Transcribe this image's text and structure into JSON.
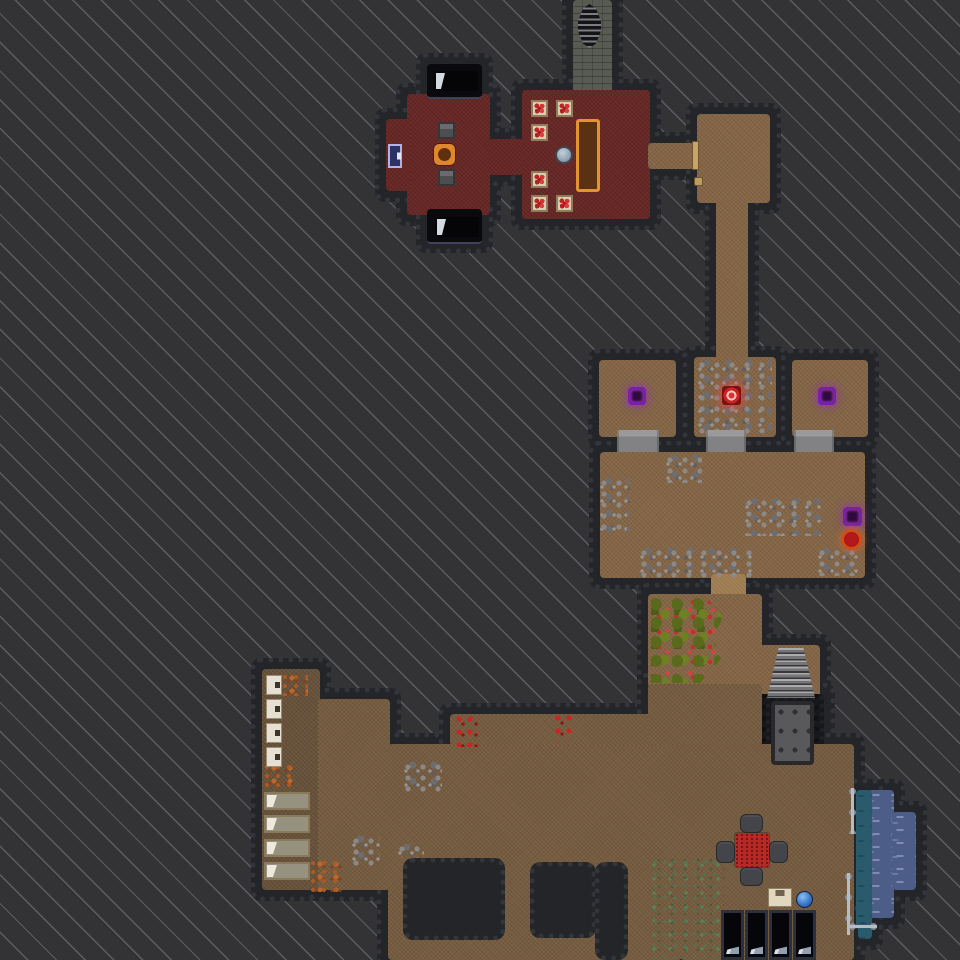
{
  "meta": {
    "width": 960,
    "height": 960,
    "view": "dungeon-overhead-map"
  },
  "palette": {
    "unexplored_bg": "#333336",
    "stripe": "#9ea0a8",
    "wall": "#242529",
    "floor_red": "#6e2c2a",
    "floor_brown": "#8a6b4b",
    "floor_brown_dark": "#6e5840",
    "floor_stone": "#575b51",
    "floor_pit": "#17181b",
    "water": "#4c5d87",
    "shallow_water": "#2a5b6d",
    "rune_purple": "#7b1fa8",
    "rune_red": "#cc2424",
    "table_orange": "#e29433",
    "door_blue": "#2c3166",
    "berry_red": "#c3302a",
    "moss_green": "#4a7a50"
  },
  "map": {
    "rooms": [
      {
        "name": "stone-stair-corridor",
        "kind": "stone",
        "rects": [
          [
            573,
            0,
            39,
            96
          ]
        ]
      },
      {
        "name": "tavern-west-wing",
        "kind": "red",
        "rects": [
          [
            407,
            94,
            83,
            121
          ],
          [
            386,
            119,
            25,
            72
          ]
        ]
      },
      {
        "name": "tavern-connector",
        "kind": "red",
        "rects": [
          [
            488,
            139,
            36,
            36
          ]
        ]
      },
      {
        "name": "tavern-dining-hall",
        "kind": "red",
        "rects": [
          [
            522,
            90,
            128,
            129
          ]
        ]
      },
      {
        "name": "bed-alcove-north",
        "kind": "void",
        "rects": [
          [
            427,
            64,
            55,
            33
          ]
        ]
      },
      {
        "name": "bed-alcove-south",
        "kind": "void",
        "rects": [
          [
            427,
            209,
            55,
            33
          ]
        ]
      },
      {
        "name": "east-passage",
        "kind": "brown",
        "rects": [
          [
            648,
            143,
            52,
            26
          ]
        ]
      },
      {
        "name": "northeast-room",
        "kind": "brown",
        "rects": [
          [
            697,
            114,
            73,
            89
          ]
        ]
      },
      {
        "name": "north-south-corridor",
        "kind": "brown",
        "rects": [
          [
            716,
            200,
            32,
            161
          ]
        ]
      },
      {
        "name": "cell-west",
        "kind": "brown",
        "rects": [
          [
            599,
            360,
            77,
            77
          ]
        ]
      },
      {
        "name": "cell-middle",
        "kind": "brown",
        "rects": [
          [
            694,
            357,
            82,
            80
          ]
        ]
      },
      {
        "name": "cell-east",
        "kind": "brown",
        "rects": [
          [
            792,
            360,
            76,
            77
          ]
        ]
      },
      {
        "name": "guard-hall",
        "kind": "brown",
        "rects": [
          [
            600,
            452,
            265,
            126
          ]
        ]
      },
      {
        "name": "hall-garden-corridor",
        "kind": "tan",
        "rects": [
          [
            711,
            574,
            35,
            26
          ]
        ]
      },
      {
        "name": "orchard-room",
        "kind": "brown",
        "rects": [
          [
            648,
            594,
            114,
            94
          ]
        ]
      },
      {
        "name": "stair-landing",
        "kind": "brown",
        "rects": [
          [
            760,
            645,
            60,
            55
          ]
        ]
      },
      {
        "name": "dark-pool-chamber",
        "kind": "pit",
        "rects": [
          [
            756,
            694,
            68,
            84
          ]
        ]
      },
      {
        "name": "dormitory-west",
        "kind": "browndark",
        "rects": [
          [
            262,
            669,
            58,
            221
          ]
        ]
      },
      {
        "name": "great-cavern-hall",
        "kind": "brown2",
        "rects": [
          [
            318,
            699,
            72,
            191
          ],
          [
            388,
            744,
            294,
            216
          ],
          [
            450,
            714,
            232,
            32
          ],
          [
            648,
            684,
            114,
            62
          ],
          [
            680,
            744,
            174,
            216
          ]
        ]
      },
      {
        "name": "water-pool",
        "kind": "water",
        "rects": [
          [
            868,
            790,
            26,
            128
          ],
          [
            892,
            812,
            24,
            78
          ]
        ]
      },
      {
        "name": "water-shore",
        "kind": "teal",
        "rects": [
          [
            856,
            790,
            16,
            140
          ],
          [
            858,
            917,
            14,
            22
          ]
        ]
      }
    ],
    "wall_blocks": [
      {
        "name": "unexplored-block-a",
        "rect": [
          403,
          858,
          102,
          82
        ]
      },
      {
        "name": "unexplored-block-b",
        "rect": [
          530,
          862,
          66,
          76
        ]
      },
      {
        "name": "unexplored-block-c",
        "rect": [
          595,
          862,
          33,
          98
        ]
      }
    ],
    "decals": [
      {
        "type": "berries",
        "rect": [
          651,
          598,
          72,
          85
        ]
      },
      {
        "type": "moss",
        "rect": [
          652,
          858,
          72,
          100
        ]
      },
      {
        "type": "rubble",
        "rect": [
          666,
          455,
          36,
          28
        ]
      },
      {
        "type": "rubble",
        "rect": [
          600,
          478,
          30,
          55
        ]
      },
      {
        "type": "rubble",
        "rect": [
          640,
          548,
          112,
          30
        ]
      },
      {
        "type": "rubble",
        "rect": [
          745,
          498,
          76,
          38
        ]
      },
      {
        "type": "rubble",
        "rect": [
          818,
          548,
          44,
          28
        ]
      },
      {
        "type": "rubble",
        "rect": [
          698,
          360,
          74,
          74
        ]
      },
      {
        "type": "rubble",
        "rect": [
          404,
          762,
          38,
          30
        ]
      },
      {
        "type": "rubble",
        "rect": [
          352,
          836,
          28,
          32
        ]
      },
      {
        "type": "rubble",
        "rect": [
          398,
          844,
          26,
          14
        ]
      },
      {
        "type": "rust",
        "rect": [
          282,
          674,
          26,
          22
        ]
      },
      {
        "type": "rust",
        "rect": [
          264,
          764,
          30,
          30
        ]
      },
      {
        "type": "rust",
        "rect": [
          310,
          860,
          34,
          32
        ]
      },
      {
        "type": "reddots",
        "rect": [
          455,
          715,
          24,
          32
        ]
      },
      {
        "type": "reddots",
        "rect": [
          554,
          714,
          18,
          28
        ]
      }
    ],
    "items": [
      {
        "name": "ladder-up",
        "type": "ladder",
        "rect": [
          578,
          4,
          23,
          44
        ],
        "interactable": true
      },
      {
        "name": "tavern-bed-north",
        "type": "bedblack",
        "rect": [
          434,
          71,
          44,
          20
        ],
        "interactable": true
      },
      {
        "name": "tavern-bed-south",
        "type": "bedblack",
        "rect": [
          435,
          217,
          44,
          20
        ],
        "interactable": true
      },
      {
        "name": "tavern-chair-north",
        "type": "chairsm",
        "rect": [
          438,
          122,
          17,
          17
        ],
        "interactable": true
      },
      {
        "name": "tavern-chair-south",
        "type": "chairsm",
        "rect": [
          438,
          169,
          17,
          17
        ],
        "interactable": true
      },
      {
        "name": "tavern-round-table",
        "type": "roundtable",
        "rect": [
          434,
          144,
          21,
          21
        ],
        "interactable": true
      },
      {
        "name": "tavern-door-west",
        "type": "doorblue",
        "rect": [
          388,
          144,
          14,
          24
        ],
        "interactable": true
      },
      {
        "name": "dining-table-1",
        "type": "foodtable",
        "rect": [
          531,
          100,
          17,
          17
        ],
        "interactable": true
      },
      {
        "name": "dining-table-2",
        "type": "foodtable",
        "rect": [
          556,
          100,
          17,
          17
        ],
        "interactable": true
      },
      {
        "name": "dining-table-3",
        "type": "foodtable",
        "rect": [
          531,
          124,
          17,
          17
        ],
        "interactable": true
      },
      {
        "name": "dining-table-4",
        "type": "foodtable",
        "rect": [
          531,
          171,
          17,
          17
        ],
        "interactable": true
      },
      {
        "name": "dining-table-5",
        "type": "foodtable",
        "rect": [
          531,
          195,
          17,
          17
        ],
        "interactable": true
      },
      {
        "name": "dining-table-6",
        "type": "foodtable",
        "rect": [
          556,
          195,
          17,
          17
        ],
        "interactable": true
      },
      {
        "name": "cauldron",
        "type": "orbgray",
        "rect": [
          555,
          146,
          18,
          18
        ],
        "interactable": true
      },
      {
        "name": "banquet-table",
        "type": "longtable",
        "rect": [
          576,
          119,
          24,
          73
        ],
        "interactable": true
      },
      {
        "name": "passage-door-east",
        "type": "doortan",
        "rect": [
          692,
          141,
          7,
          29
        ],
        "interactable": true
      },
      {
        "name": "wall-lever",
        "type": "knobtan",
        "rect": [
          694,
          177,
          9,
          9
        ],
        "interactable": true
      },
      {
        "name": "purple-rune-west",
        "type": "runepurple",
        "rect": [
          628,
          387,
          18,
          18
        ],
        "interactable": true
      },
      {
        "name": "red-rune-middle",
        "type": "runered",
        "rect": [
          722,
          386,
          19,
          19
        ],
        "interactable": true
      },
      {
        "name": "purple-rune-east",
        "type": "runepurple",
        "rect": [
          818,
          387,
          18,
          18
        ],
        "interactable": true
      },
      {
        "name": "ramp-west",
        "type": "ramp",
        "rect": [
          617,
          430,
          42,
          22
        ],
        "interactable": false
      },
      {
        "name": "ramp-middle",
        "type": "ramp",
        "rect": [
          706,
          430,
          40,
          22
        ],
        "interactable": false
      },
      {
        "name": "ramp-east",
        "type": "ramp",
        "rect": [
          794,
          430,
          40,
          22
        ],
        "interactable": false
      },
      {
        "name": "hall-purple-rune",
        "type": "runepurple",
        "rect": [
          843,
          507,
          19,
          19
        ],
        "interactable": true
      },
      {
        "name": "hall-red-orb",
        "type": "orbred",
        "rect": [
          841,
          529,
          21,
          21
        ],
        "interactable": true
      },
      {
        "name": "stone-stairs",
        "type": "stairs",
        "rect": [
          767,
          648,
          48,
          50
        ],
        "interactable": true
      },
      {
        "name": "pool-grate",
        "type": "plate",
        "rect": [
          771,
          701,
          43,
          64
        ],
        "interactable": true
      },
      {
        "name": "white-chest-1",
        "type": "chest",
        "rect": [
          266,
          675,
          16,
          20
        ],
        "interactable": true
      },
      {
        "name": "white-chest-2",
        "type": "chest",
        "rect": [
          266,
          699,
          16,
          20
        ],
        "interactable": true
      },
      {
        "name": "white-chest-3",
        "type": "chest",
        "rect": [
          266,
          723,
          16,
          20
        ],
        "interactable": true
      },
      {
        "name": "white-chest-4",
        "type": "chest",
        "rect": [
          266,
          747,
          16,
          20
        ],
        "interactable": true
      },
      {
        "name": "dorm-bed-1",
        "type": "bedtan",
        "rect": [
          264,
          792,
          46,
          18
        ],
        "interactable": true
      },
      {
        "name": "dorm-bed-2",
        "type": "bedtan",
        "rect": [
          264,
          815,
          46,
          18
        ],
        "interactable": true
      },
      {
        "name": "dorm-bed-3",
        "type": "bedtan",
        "rect": [
          264,
          839,
          46,
          18
        ],
        "interactable": true
      },
      {
        "name": "dorm-bed-4",
        "type": "bedtan",
        "rect": [
          264,
          862,
          46,
          18
        ],
        "interactable": true
      },
      {
        "name": "feast-table",
        "type": "tablered",
        "rect": [
          735,
          833,
          34,
          34
        ],
        "interactable": true
      },
      {
        "name": "feast-chair-north",
        "type": "chairdark",
        "rect": [
          740,
          814,
          23,
          19
        ],
        "interactable": true
      },
      {
        "name": "feast-chair-west",
        "type": "chairdark",
        "rect": [
          716,
          841,
          19,
          22
        ],
        "interactable": true
      },
      {
        "name": "feast-chair-east",
        "type": "chairdark",
        "rect": [
          769,
          841,
          19,
          22
        ],
        "interactable": true
      },
      {
        "name": "feast-chair-south",
        "type": "chairdark",
        "rect": [
          740,
          867,
          23,
          19
        ],
        "interactable": true
      },
      {
        "name": "supply-crate",
        "type": "crate",
        "rect": [
          768,
          888,
          24,
          19
        ],
        "interactable": true
      },
      {
        "name": "blue-orb",
        "type": "orbblue",
        "rect": [
          796,
          891,
          17,
          17
        ],
        "interactable": true
      },
      {
        "name": "display-case-1",
        "type": "case",
        "rect": [
          721,
          910,
          23,
          50
        ],
        "interactable": true
      },
      {
        "name": "display-case-2",
        "type": "case",
        "rect": [
          745,
          910,
          23,
          50
        ],
        "interactable": true
      },
      {
        "name": "display-case-3",
        "type": "case",
        "rect": [
          769,
          910,
          23,
          50
        ],
        "interactable": true
      },
      {
        "name": "display-case-4",
        "type": "case",
        "rect": [
          793,
          910,
          23,
          50
        ],
        "interactable": true
      },
      {
        "name": "railing-upper",
        "type": "fencev",
        "rect": [
          849,
          788,
          7,
          46
        ],
        "interactable": false
      },
      {
        "name": "railing-lower",
        "type": "fencev",
        "rect": [
          845,
          873,
          7,
          62
        ],
        "interactable": false
      },
      {
        "name": "railing-foot",
        "type": "fenceh",
        "rect": [
          849,
          923,
          28,
          7
        ],
        "interactable": false
      }
    ]
  }
}
